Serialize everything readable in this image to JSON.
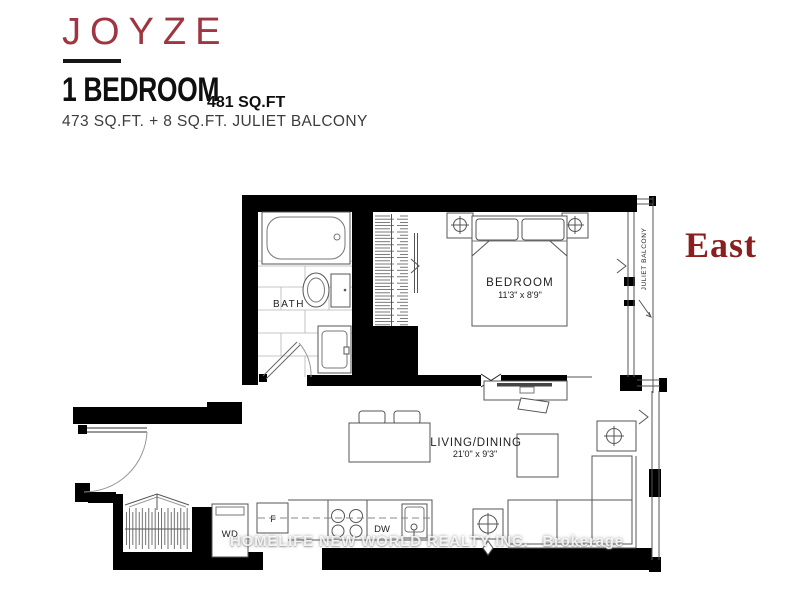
{
  "header": {
    "brand": "JOYZE",
    "unit_type": "1 BEDROOM",
    "area_total": "481 SQ.FT",
    "area_breakdown": "473 SQ.FT. + 8 SQ.FT. JULIET BALCONY"
  },
  "orientation_label": "East",
  "floorplan": {
    "rooms": {
      "bath": {
        "label": "BATH"
      },
      "bedroom": {
        "label": "BEDROOM",
        "dimensions": "11'3\" x 8'9\""
      },
      "living_dining": {
        "label": "LIVING/DINING",
        "dimensions": "21'0\" x 9'3\""
      }
    },
    "appliances": {
      "washer_dryer": "WD",
      "fridge": "F",
      "dishwasher": "DW"
    },
    "balcony_label": "JULIET BALCONY"
  },
  "watermark": {
    "realty": "HOMELIFE NEW WORLD REALTY INC.",
    "suffix": "Brokerage"
  },
  "colors": {
    "brand_red": "#9e3540",
    "east_red": "#8b1e1e",
    "wall_black": "#000000"
  }
}
